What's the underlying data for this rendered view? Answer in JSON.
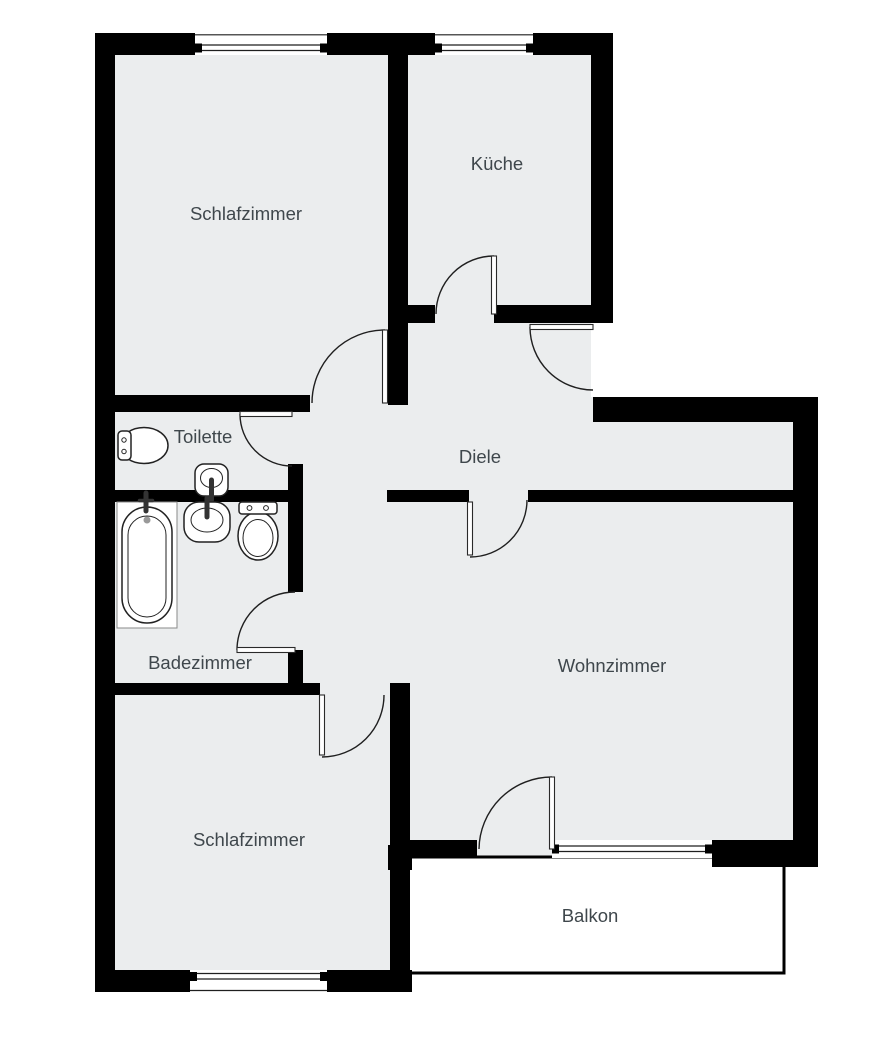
{
  "floorplan": {
    "kind": "apartment-floor-plan",
    "language": "de",
    "colors": {
      "wall": "#000000",
      "room_fill": "#ebedee",
      "balcony_fill": "#ffffff",
      "label_text": "#3f474c",
      "background": "#ffffff"
    },
    "rooms": [
      {
        "id": "schlafzimmer-oben",
        "label": "Schlafzimmer"
      },
      {
        "id": "kueche",
        "label": "Küche"
      },
      {
        "id": "toilette",
        "label": "Toilette"
      },
      {
        "id": "diele",
        "label": "Diele"
      },
      {
        "id": "badezimmer",
        "label": "Badezimmer"
      },
      {
        "id": "wohnzimmer",
        "label": "Wohnzimmer"
      },
      {
        "id": "schlafzimmer-unten",
        "label": "Schlafzimmer"
      },
      {
        "id": "balkon",
        "label": "Balkon"
      }
    ],
    "fixtures": [
      {
        "room": "Toilette",
        "items": [
          "toilet",
          "hand-wash-basin"
        ]
      },
      {
        "room": "Badezimmer",
        "items": [
          "bathtub",
          "wash-basin",
          "toilet"
        ]
      }
    ],
    "openings": {
      "doors": 8,
      "windows": 4
    }
  }
}
